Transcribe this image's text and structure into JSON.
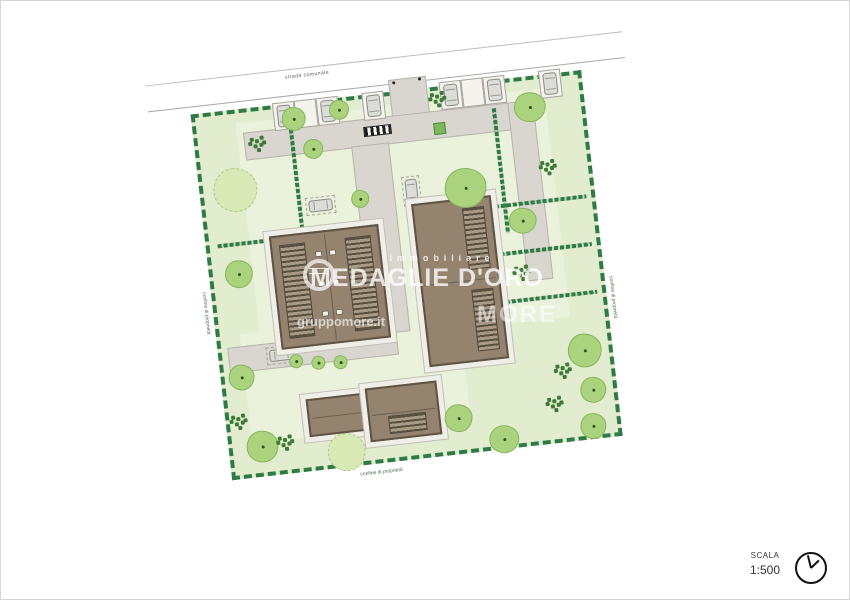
{
  "plan": {
    "road_label": "strada comunale",
    "boundary_label": "confine di proprietà",
    "colors": {
      "lawn": "#e2ecce",
      "lawn_light": "#ebf2dc",
      "hedge_green": "#2e7b45",
      "road_gray": "#d9d6cf",
      "roof_brown": "#93836f",
      "roof_outline": "#5f5444",
      "tree_green": "#abd37e",
      "tree_light_green": "#d9e9b6"
    }
  },
  "watermark": {
    "line1": "immobiliare",
    "line2": "MEDAGLIE D'ORO",
    "site_url": "gruppomore.it",
    "brand": "MORE"
  },
  "scale": {
    "label": "SCALA",
    "value": "1:500"
  }
}
